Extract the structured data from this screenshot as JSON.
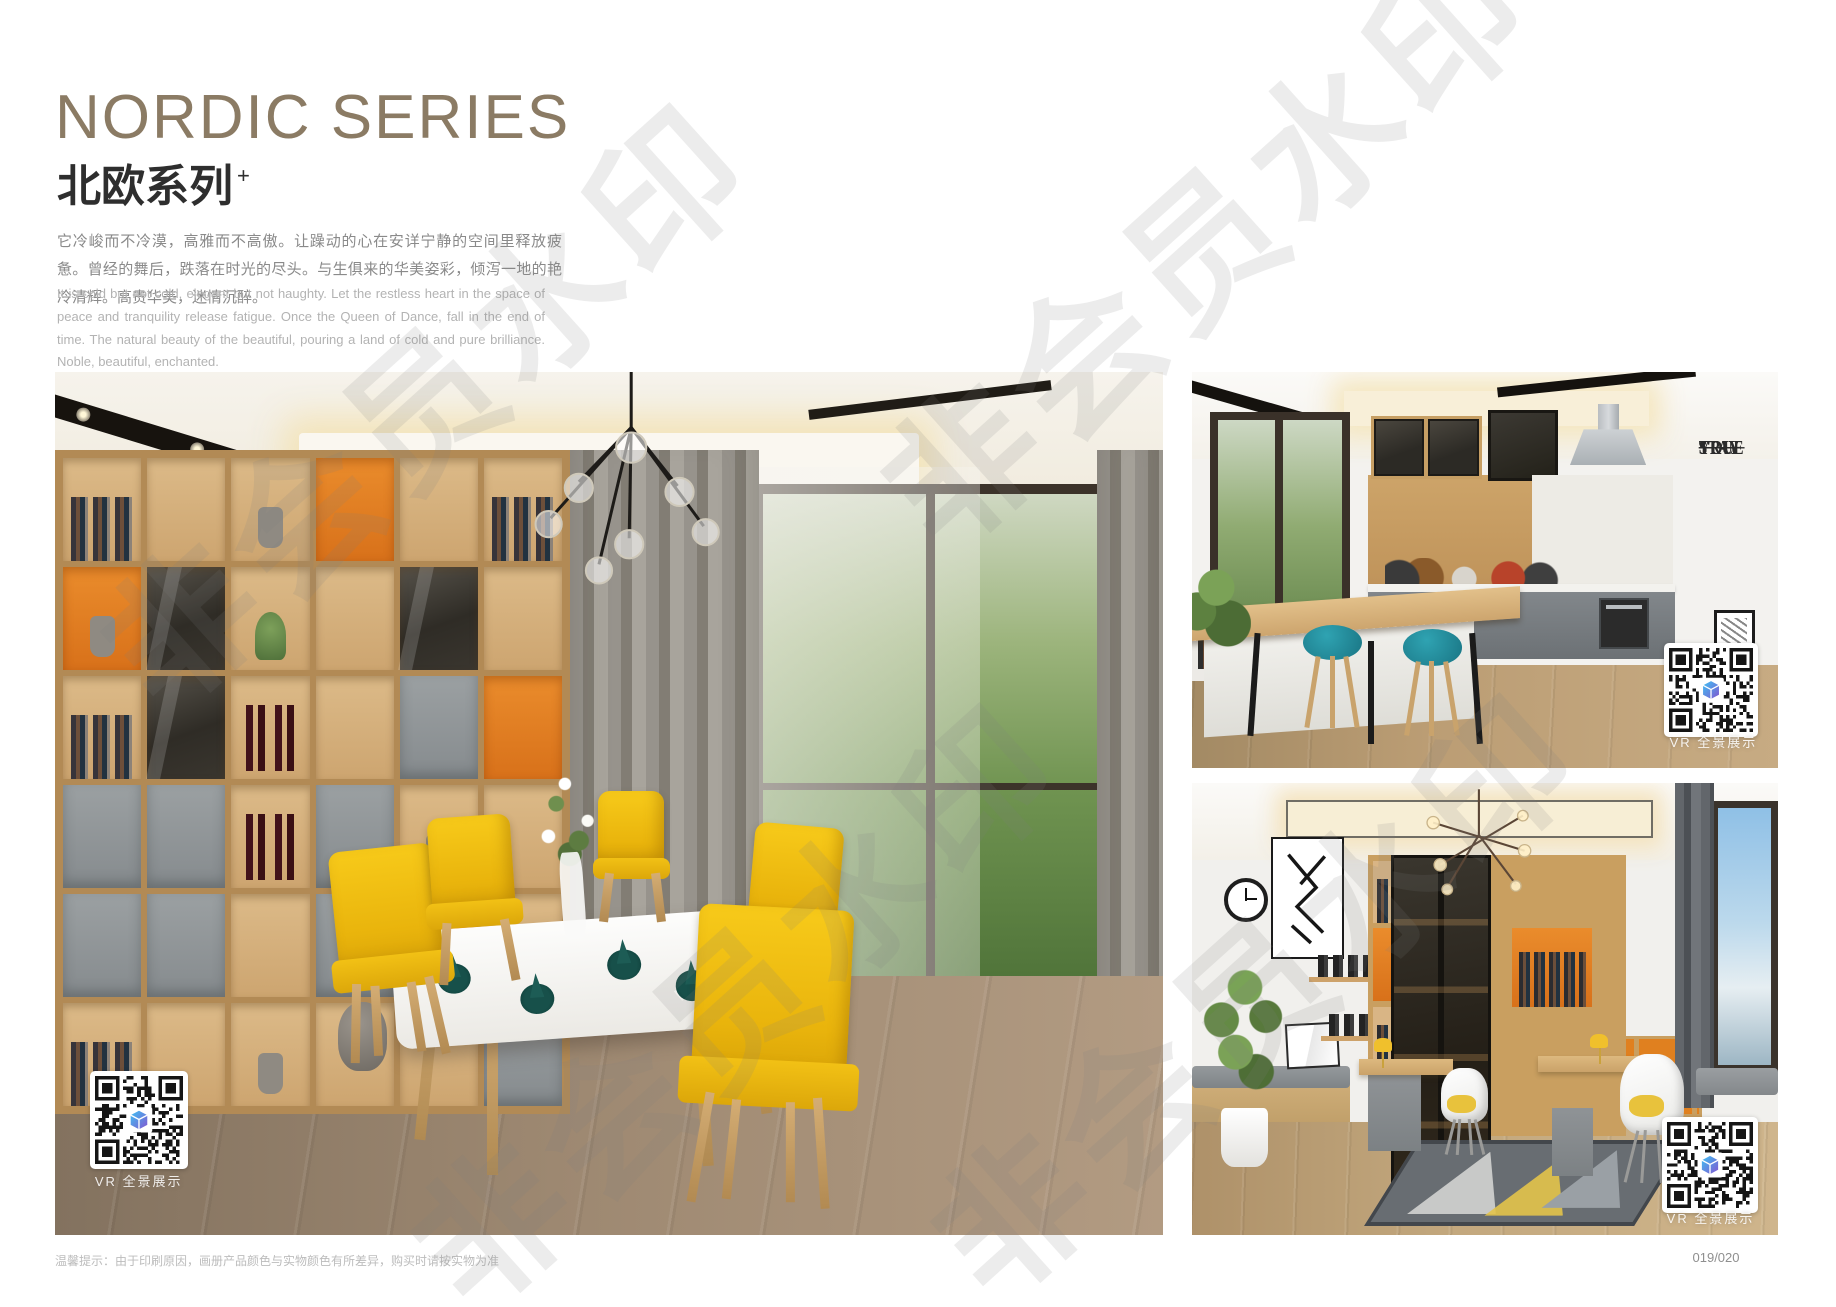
{
  "header": {
    "title_en": "NORDIC SERIES",
    "title_zh": "北欧系列",
    "title_sup": "+",
    "intro_zh": "它冷峻而不冷漠，高雅而不高傲。让躁动的心在安详宁静的空间里释放疲惫。曾经的舞后，跌落在时光的尽头。与生俱来的华美姿彩，倾泻一地的艳冷清辉。高贵华美，迷情沉醉。",
    "intro_en": "It is cold but not cold, elegant but not haughty. Let the restless heart in the space of peace and tranquility release fatigue. Once the Queen of Dance, fall in the end of time. The natural beauty of the beautiful, pouring a land of cold and pure brilliance. Noble, beautiful, enchanted."
  },
  "gallery": {
    "vr_label": "VR 全景展示",
    "wall_decal_lines": [
      "STAY",
      "TRUE",
      "STAY",
      "YOU"
    ]
  },
  "footer": {
    "note": "温馨提示：由于印刷原因，画册产品颜色与实物颜色有所差异，购买时请按实物为准",
    "page_number": "019/020"
  },
  "watermark": {
    "text": "非会员水印"
  },
  "colors": {
    "title_taupe": "#8b7b64",
    "accent_orange": "#e07a1e",
    "chair_yellow": "#f2c318",
    "stool_teal": "#1f8796",
    "qr_logo_blue": "#3ec1f3",
    "qr_logo_purple": "#8256d0"
  }
}
